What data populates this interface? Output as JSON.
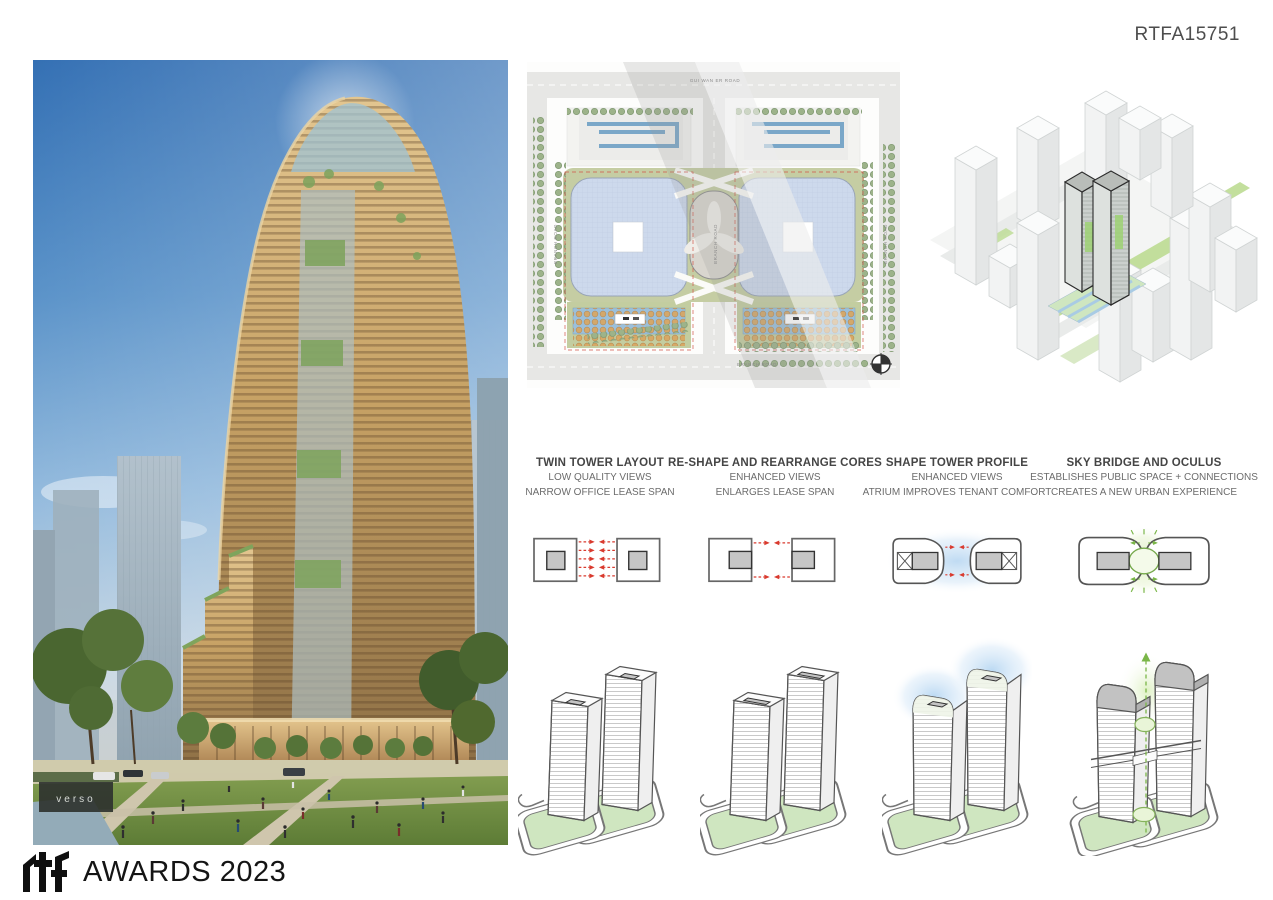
{
  "board": {
    "submission_code": "RTFA15751",
    "footer": {
      "logo": "rtf",
      "text": "AWARDS 2023"
    }
  },
  "hero_photo": {
    "storefront_sign": "verso"
  },
  "site_plan": {
    "road_top": "GUI WAN ER ROAD",
    "road_left": "BRANCH ROAD",
    "road_center": "BRANCH ROAD",
    "road_right": "BRANCH ROAD",
    "road_bottom": "BRANCH ROAD"
  },
  "design_steps": [
    {
      "title": "TWIN TOWER LAYOUT",
      "lines": [
        "LOW QUALITY VIEWS",
        "NARROW OFFICE LEASE SPAN"
      ]
    },
    {
      "title": "RE-SHAPE AND REARRANGE CORES",
      "lines": [
        "ENHANCED VIEWS",
        "ENLARGES LEASE SPAN"
      ]
    },
    {
      "title": "SHAPE TOWER PROFILE",
      "lines": [
        "ENHANCED VIEWS",
        "ATRIUM IMPROVES TENANT COMFORT"
      ]
    },
    {
      "title": "SKY BRIDGE AND OCULUS",
      "lines": [
        "ESTABLISHES PUBLIC SPACE + CONNECTIONS",
        "CREATES A NEW URBAN EXPERIENCE"
      ]
    }
  ],
  "colors": {
    "accent_green": "#7ab648",
    "arrow_red": "#d93a2e",
    "glow_blue": "#c8e0f5",
    "plan_blue": "#cdd9ec",
    "base_green": "#cfe6c0",
    "core_gray": "#c6c6c6"
  }
}
